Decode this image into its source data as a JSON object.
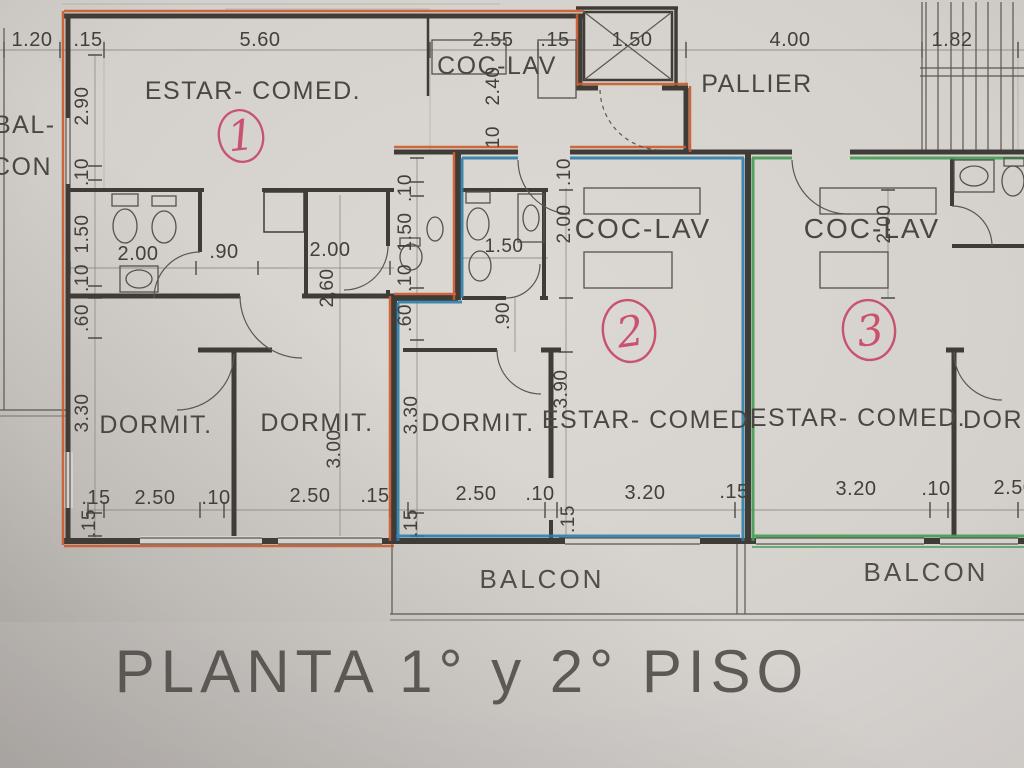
{
  "title": "PLANTA 1° y 2° PISO",
  "colors": {
    "unit1_outline": "#cc5a2e",
    "unit2_outline": "#2a7dab",
    "unit3_outline": "#3f9b52",
    "handwritten_mark": "#c9536e",
    "ink": "#3f3c37",
    "paper": "#d5d1cc"
  },
  "rooms": {
    "unit1_estar": "ESTAR- COMED.",
    "unit1_coclav": "COC-LAV",
    "pallier": "PALLIER",
    "balcon_left_line1": "BAL-",
    "balcon_left_line2": "CON",
    "unit2_coclav": "COC-LAV",
    "unit3_coclav": "COC-LAV",
    "unit1_dorm1": "DORMIT.",
    "unit1_dorm2": "DORMIT.",
    "unit2_dorm": "DORMIT.",
    "unit3_dorm": "DORMIT.",
    "unit2_estar": "ESTAR- COMED.",
    "unit3_estar": "ESTAR- COMED.",
    "balcon2": "BALCON",
    "balcon3": "BALCON"
  },
  "marks": {
    "unit1": "1",
    "unit2": "2",
    "unit3": "3"
  },
  "dims": {
    "top": {
      "d1": "1.20",
      "d2": ".15",
      "d3": "5.60",
      "d4": "2.55",
      "d5": ".15",
      "d6": "1.50",
      "d7": "4.00",
      "d8": "1.82"
    },
    "left_col": {
      "d1": "2.90",
      "d2": ".10",
      "d3": "1.50",
      "d4": ".10",
      "d5": ".60",
      "d6": "3.30",
      "d7": ".15"
    },
    "center_col": {
      "d1": ".10",
      "d2": "1.50",
      "d3": ".10",
      "d4": ".60",
      "d5": "3.30",
      "d6": ".15"
    },
    "bath1_row": {
      "d1": "2.00",
      "d2": ".90",
      "d3": "2.00"
    },
    "unit1_rot": {
      "d1": "2,60",
      "d2": "3.00",
      "d3": "2.40",
      "d4": ".10"
    },
    "unit2_col": {
      "d1": "2.00",
      "d2": ".10",
      "d3": "1.50",
      "d4": ".90",
      "d5": "3.90",
      "d6": ".15"
    },
    "unit3_col": {
      "d1": "2.00"
    },
    "bottom": {
      "d1": ".15",
      "d2": "2.50",
      "d3": ".10",
      "d4": "2.50",
      "d5": ".15",
      "d6": "2.50",
      "d7": ".10",
      "d8": "3.20",
      "d9": ".15",
      "d10": "3.20",
      "d11": ".10",
      "d12": "2.50"
    },
    "bottom_rot": {
      "d1": ".15"
    }
  }
}
